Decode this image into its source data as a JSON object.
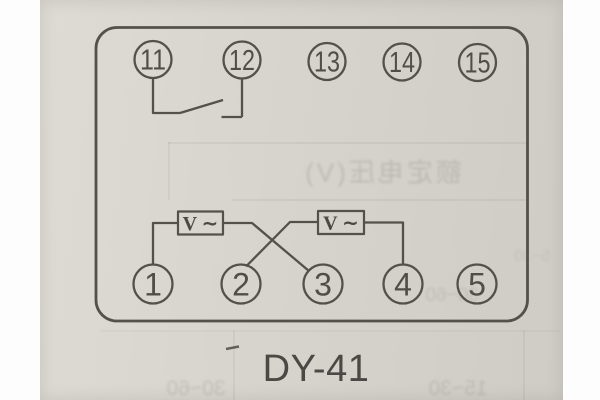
{
  "caption": "DY-41",
  "terminals": {
    "top": [
      "11",
      "12",
      "13",
      "14",
      "15"
    ],
    "bottom": [
      "1",
      "2",
      "3",
      "4",
      "5"
    ]
  },
  "meters": {
    "left": "V ∼",
    "right": "V ∼"
  },
  "ghosts": {
    "header": "额定电压(V)",
    "mid": "30~60",
    "side": "5~30",
    "bottom_left": "30~60",
    "bottom_right": "15~30"
  },
  "colors": {
    "ink": "#54514c",
    "paper": "#d7d4cd",
    "page_margin": "#fdfdfd",
    "caption_ink": "#4b4845"
  }
}
